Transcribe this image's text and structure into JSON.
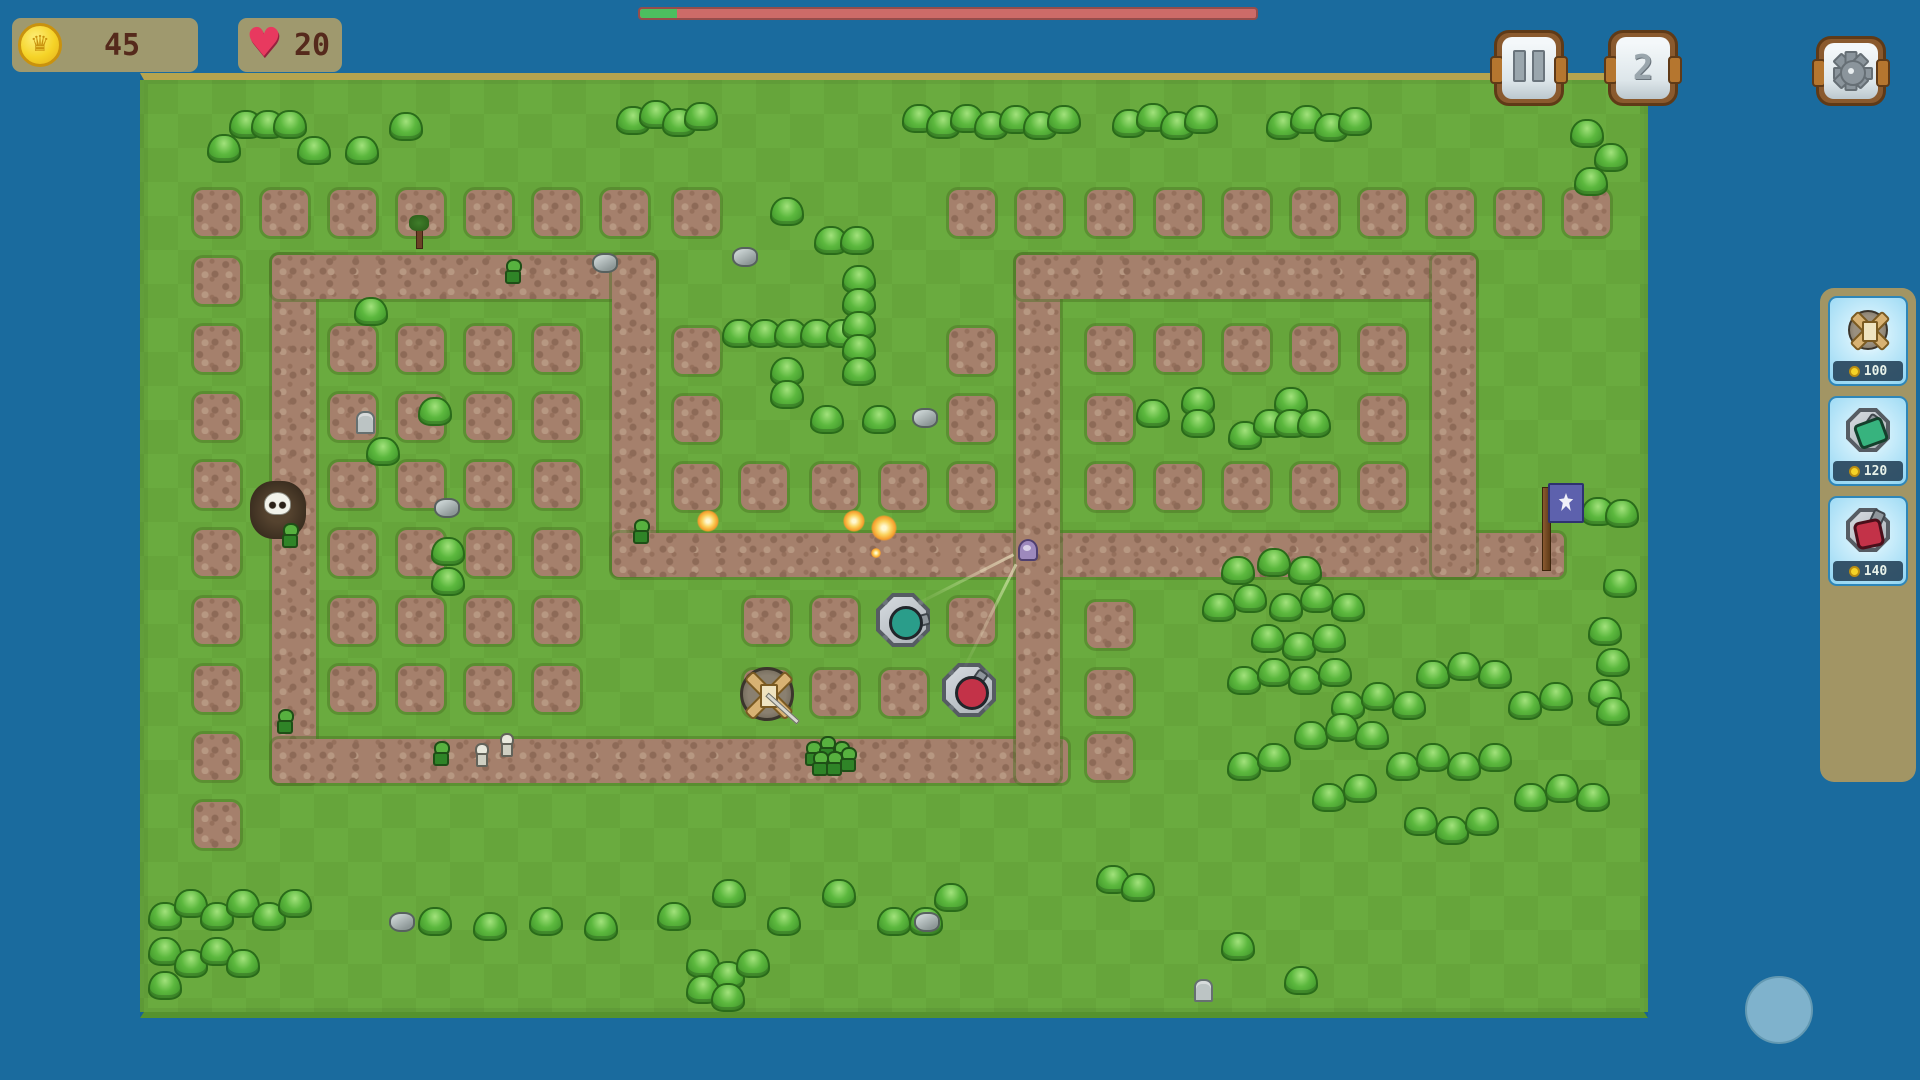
{
  "hud": {
    "coins": {
      "value": "45",
      "icon": "coin-crown"
    },
    "lives": {
      "value": "20",
      "icon": "heart"
    },
    "wave_progress": {
      "percent": 6,
      "track_color": "#cd6b68",
      "fill_color": "#4cbf5f"
    },
    "buttons": {
      "pause": "pause",
      "speed_label": "2",
      "settings": "gear"
    }
  },
  "shop": {
    "items": [
      {
        "name": "crossbow-tower",
        "price": "100"
      },
      {
        "name": "green-cannon-tower",
        "price": "120"
      },
      {
        "name": "red-cannon-tower",
        "price": "140"
      }
    ]
  },
  "colors": {
    "background": "#1a6b9e",
    "grass": "#68a93e",
    "dirt": "#a5806c",
    "panel_tan": "#a69c6b",
    "shop_tan": "#a29564",
    "card_blue": "#8fd4f2",
    "coin_gold": "#f5d327",
    "heart_pink": "#e8395f",
    "bar_red": "#cd6b68",
    "bar_green": "#4cbf5f",
    "joystick_blue": "#7fb2cc"
  },
  "map": {
    "paths": [
      [
        128,
        175,
        44,
        528
      ],
      [
        128,
        175,
        384,
        44
      ],
      [
        468,
        175,
        44,
        320
      ],
      [
        468,
        453,
        952,
        44
      ],
      [
        128,
        659,
        796,
        44
      ],
      [
        872,
        175,
        44,
        528
      ],
      [
        872,
        175,
        460,
        44
      ],
      [
        1288,
        175,
        44,
        322
      ]
    ],
    "dirt_squares": [
      [
        50,
        110
      ],
      [
        118,
        110
      ],
      [
        186,
        110
      ],
      [
        254,
        110
      ],
      [
        322,
        110
      ],
      [
        390,
        110
      ],
      [
        458,
        110
      ],
      [
        530,
        110
      ],
      [
        805,
        110
      ],
      [
        873,
        110
      ],
      [
        943,
        110
      ],
      [
        1012,
        110
      ],
      [
        1080,
        110
      ],
      [
        1148,
        110
      ],
      [
        1216,
        110
      ],
      [
        1284,
        110
      ],
      [
        1352,
        110
      ],
      [
        1420,
        110
      ],
      [
        50,
        178
      ],
      [
        50,
        246
      ],
      [
        186,
        246
      ],
      [
        254,
        246
      ],
      [
        322,
        246
      ],
      [
        390,
        246
      ],
      [
        530,
        248
      ],
      [
        805,
        248
      ],
      [
        943,
        246
      ],
      [
        1012,
        246
      ],
      [
        1080,
        246
      ],
      [
        1148,
        246
      ],
      [
        1216,
        246
      ],
      [
        50,
        314
      ],
      [
        186,
        314
      ],
      [
        254,
        314
      ],
      [
        322,
        314
      ],
      [
        390,
        314
      ],
      [
        530,
        316
      ],
      [
        805,
        316
      ],
      [
        943,
        316
      ],
      [
        1216,
        316
      ],
      [
        50,
        382
      ],
      [
        186,
        382
      ],
      [
        254,
        382
      ],
      [
        322,
        382
      ],
      [
        390,
        382
      ],
      [
        530,
        384
      ],
      [
        597,
        384
      ],
      [
        668,
        384
      ],
      [
        737,
        384
      ],
      [
        805,
        384
      ],
      [
        943,
        384
      ],
      [
        1012,
        384
      ],
      [
        1080,
        384
      ],
      [
        1148,
        384
      ],
      [
        1216,
        384
      ],
      [
        50,
        450
      ],
      [
        186,
        450
      ],
      [
        254,
        450
      ],
      [
        322,
        450
      ],
      [
        390,
        450
      ],
      [
        50,
        518
      ],
      [
        186,
        518
      ],
      [
        254,
        518
      ],
      [
        322,
        518
      ],
      [
        390,
        518
      ],
      [
        600,
        518
      ],
      [
        668,
        518
      ],
      [
        805,
        518
      ],
      [
        943,
        522
      ],
      [
        50,
        586
      ],
      [
        186,
        586
      ],
      [
        254,
        586
      ],
      [
        322,
        586
      ],
      [
        390,
        586
      ],
      [
        600,
        590
      ],
      [
        668,
        590
      ],
      [
        737,
        590
      ],
      [
        943,
        590
      ],
      [
        50,
        654
      ],
      [
        943,
        654
      ],
      [
        50,
        722
      ]
    ],
    "bushes": [
      [
        85,
        30
      ],
      [
        107,
        30
      ],
      [
        129,
        30
      ],
      [
        245,
        32
      ],
      [
        63,
        54
      ],
      [
        153,
        56
      ],
      [
        201,
        56
      ],
      [
        472,
        26
      ],
      [
        495,
        20
      ],
      [
        518,
        28
      ],
      [
        540,
        22
      ],
      [
        758,
        24
      ],
      [
        782,
        30
      ],
      [
        806,
        24
      ],
      [
        830,
        31
      ],
      [
        855,
        25
      ],
      [
        879,
        31
      ],
      [
        903,
        25
      ],
      [
        968,
        29
      ],
      [
        992,
        23
      ],
      [
        1016,
        31
      ],
      [
        1040,
        25
      ],
      [
        1122,
        31
      ],
      [
        1146,
        25
      ],
      [
        1170,
        33
      ],
      [
        1194,
        27
      ],
      [
        1426,
        39
      ],
      [
        1450,
        63
      ],
      [
        1430,
        87
      ],
      [
        626,
        117
      ],
      [
        670,
        146
      ],
      [
        696,
        146
      ],
      [
        578,
        239
      ],
      [
        604,
        239
      ],
      [
        630,
        239
      ],
      [
        656,
        239
      ],
      [
        682,
        239
      ],
      [
        698,
        185
      ],
      [
        698,
        208
      ],
      [
        698,
        231
      ],
      [
        698,
        254
      ],
      [
        698,
        277
      ],
      [
        626,
        277
      ],
      [
        626,
        300
      ],
      [
        666,
        325
      ],
      [
        718,
        325
      ],
      [
        210,
        217
      ],
      [
        274,
        317
      ],
      [
        222,
        357
      ],
      [
        287,
        457
      ],
      [
        287,
        487
      ],
      [
        992,
        319
      ],
      [
        1037,
        307
      ],
      [
        1037,
        329
      ],
      [
        1084,
        341
      ],
      [
        1109,
        329
      ],
      [
        1130,
        307
      ],
      [
        1130,
        329
      ],
      [
        1153,
        329
      ],
      [
        1437,
        417
      ],
      [
        1461,
        419
      ],
      [
        1459,
        489
      ],
      [
        1444,
        537
      ],
      [
        1452,
        568
      ],
      [
        1444,
        599
      ],
      [
        1452,
        617
      ],
      [
        1077,
        476
      ],
      [
        1113,
        468
      ],
      [
        1144,
        476
      ],
      [
        1058,
        513
      ],
      [
        1089,
        504
      ],
      [
        1125,
        513
      ],
      [
        1156,
        504
      ],
      [
        1187,
        513
      ],
      [
        1107,
        544
      ],
      [
        1138,
        552
      ],
      [
        1168,
        544
      ],
      [
        1083,
        586
      ],
      [
        1113,
        578
      ],
      [
        1144,
        586
      ],
      [
        1174,
        578
      ],
      [
        1187,
        611
      ],
      [
        1217,
        602
      ],
      [
        1248,
        611
      ],
      [
        1272,
        580
      ],
      [
        1303,
        572
      ],
      [
        1334,
        580
      ],
      [
        1364,
        611
      ],
      [
        1395,
        602
      ],
      [
        1150,
        641
      ],
      [
        1181,
        633
      ],
      [
        1211,
        641
      ],
      [
        1242,
        672
      ],
      [
        1272,
        663
      ],
      [
        1303,
        672
      ],
      [
        1334,
        663
      ],
      [
        1083,
        672
      ],
      [
        1113,
        663
      ],
      [
        1168,
        703
      ],
      [
        1199,
        694
      ],
      [
        1370,
        703
      ],
      [
        1401,
        694
      ],
      [
        1432,
        703
      ],
      [
        1260,
        727
      ],
      [
        1291,
        736
      ],
      [
        1321,
        727
      ],
      [
        4,
        822
      ],
      [
        30,
        809
      ],
      [
        56,
        822
      ],
      [
        82,
        809
      ],
      [
        108,
        822
      ],
      [
        134,
        809
      ],
      [
        4,
        857
      ],
      [
        30,
        869
      ],
      [
        56,
        857
      ],
      [
        4,
        891
      ],
      [
        82,
        869
      ],
      [
        274,
        827
      ],
      [
        329,
        832
      ],
      [
        385,
        827
      ],
      [
        440,
        832
      ],
      [
        513,
        822
      ],
      [
        568,
        799
      ],
      [
        623,
        827
      ],
      [
        678,
        799
      ],
      [
        733,
        827
      ],
      [
        542,
        869
      ],
      [
        567,
        881
      ],
      [
        592,
        869
      ],
      [
        542,
        895
      ],
      [
        567,
        903
      ],
      [
        765,
        827
      ],
      [
        790,
        803
      ],
      [
        952,
        785
      ],
      [
        977,
        793
      ],
      [
        1077,
        852
      ],
      [
        1140,
        886
      ]
    ],
    "rocks": [
      [
        588,
        167
      ],
      [
        768,
        328
      ],
      [
        290,
        418
      ],
      [
        448,
        173
      ],
      [
        245,
        832
      ],
      [
        770,
        832
      ]
    ],
    "gravestones": [
      [
        212,
        331
      ],
      [
        1050,
        899
      ]
    ],
    "trees": [
      [
        265,
        135
      ]
    ],
    "spawn": {
      "patch": [
        106,
        401
      ],
      "skull": [
        120,
        412
      ]
    },
    "flag": {
      "pole": [
        1398,
        407
      ],
      "banner": [
        1404,
        403
      ]
    },
    "towers": [
      {
        "type": "tank",
        "x": 732,
        "y": 513,
        "color": "#2a9d8a",
        "angle": -15
      },
      {
        "type": "tank",
        "x": 798,
        "y": 583,
        "color": "#c33248",
        "angle": -55
      },
      {
        "type": "crossbow",
        "x": 596,
        "y": 587,
        "angle": 42
      }
    ],
    "enemies": [
      {
        "type": "goblin",
        "x": 137,
        "y": 443
      },
      {
        "type": "goblin",
        "x": 132,
        "y": 629
      },
      {
        "type": "goblin",
        "x": 288,
        "y": 661
      },
      {
        "type": "goblin",
        "x": 488,
        "y": 439
      },
      {
        "type": "goblin",
        "x": 360,
        "y": 179
      },
      {
        "type": "goblin",
        "x": 660,
        "y": 661
      },
      {
        "type": "goblin",
        "x": 674,
        "y": 656
      },
      {
        "type": "goblin",
        "x": 688,
        "y": 661
      },
      {
        "type": "goblin",
        "x": 667,
        "y": 671
      },
      {
        "type": "goblin",
        "x": 681,
        "y": 671
      },
      {
        "type": "goblin",
        "x": 695,
        "y": 667
      },
      {
        "type": "skeleton",
        "x": 330,
        "y": 663
      },
      {
        "type": "skeleton",
        "x": 355,
        "y": 653
      },
      {
        "type": "ghost",
        "x": 874,
        "y": 459
      }
    ],
    "explosions": [
      {
        "x": 564,
        "y": 441,
        "r": 11
      },
      {
        "x": 710,
        "y": 441,
        "r": 11
      },
      {
        "x": 740,
        "y": 448,
        "r": 13
      },
      {
        "x": 732,
        "y": 473,
        "r": 5
      }
    ],
    "beams": [
      {
        "x1": 768,
        "y1": 525,
        "x2": 870,
        "y2": 473
      },
      {
        "x1": 818,
        "y1": 591,
        "x2": 872,
        "y2": 483
      }
    ]
  }
}
